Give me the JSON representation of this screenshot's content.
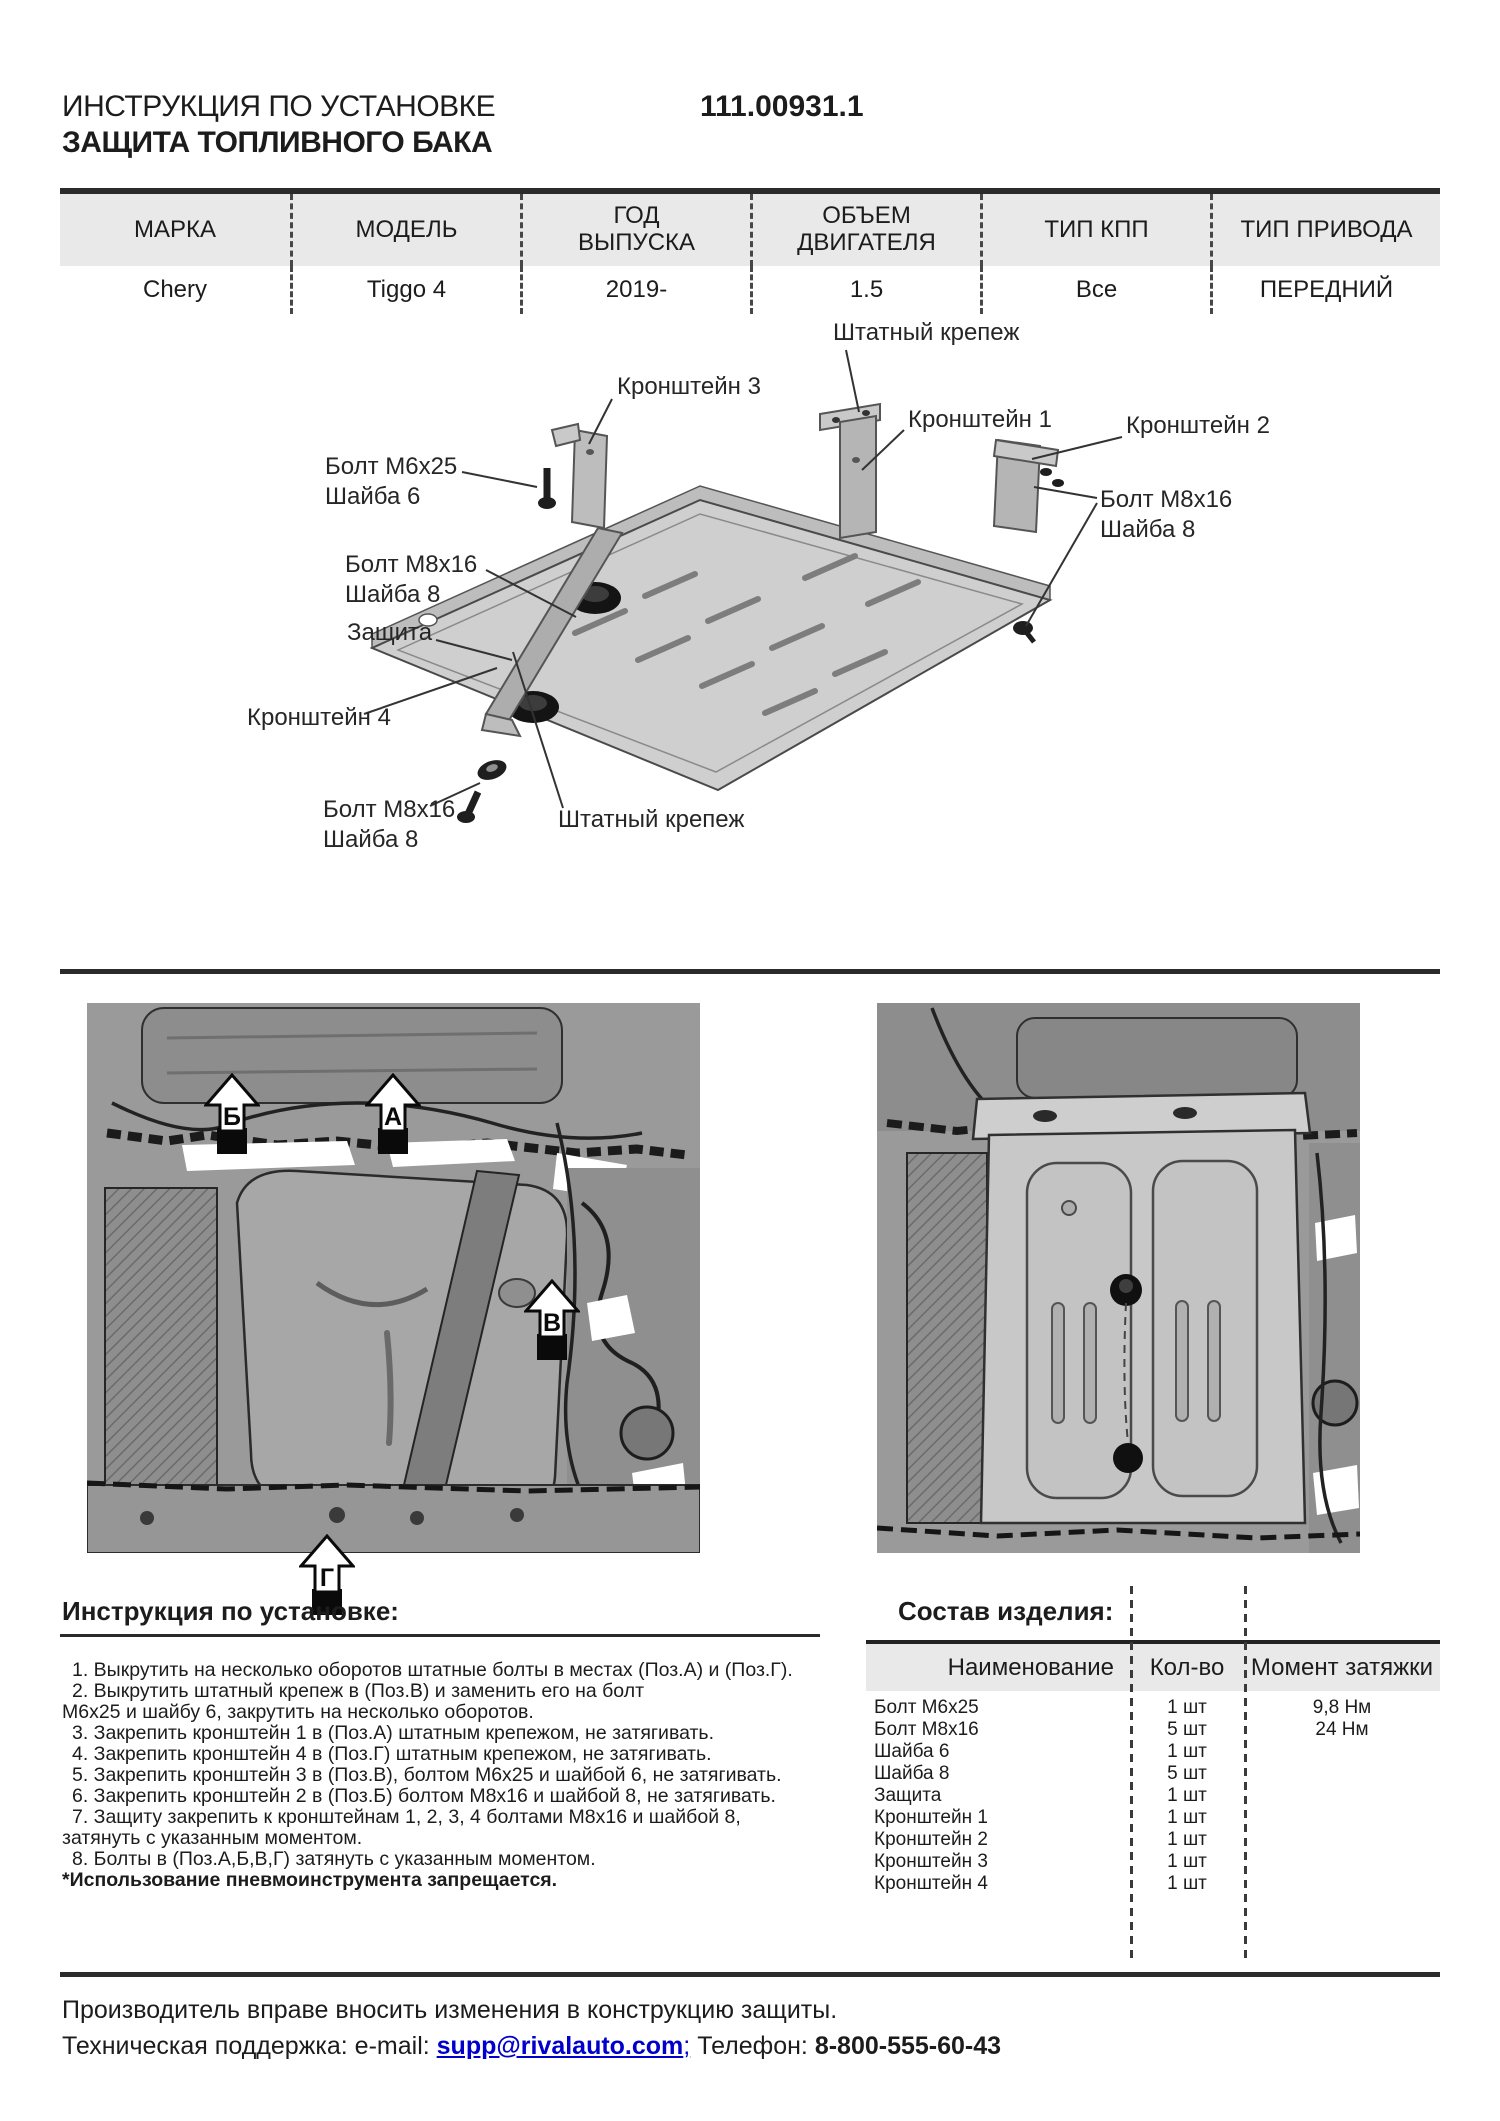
{
  "header": {
    "title_line1": "ИНСТРУКЦИЯ ПО УСТАНОВКЕ",
    "title_line2": "ЗАЩИТА ТОПЛИВНОГО БАКА",
    "part_number": "111.00931.1"
  },
  "vehicle_table": {
    "columns": [
      "МАРКА",
      "МОДЕЛЬ",
      "ГОД ВЫПУСКА",
      "ОБЪЕМ ДВИГАТЕЛЯ",
      "ТИП КПП",
      "ТИП ПРИВОДА"
    ],
    "values": [
      "Chery",
      "Tiggo 4",
      "2019-",
      "1.5",
      "Все",
      "ПЕРЕДНИЙ"
    ]
  },
  "diagram": {
    "labels": {
      "fastener_top": "Штатный крепеж",
      "bracket3": "Кронштейн 3",
      "bracket1": "Кронштейн 1",
      "bracket2": "Кронштейн 2",
      "bolt_m6": [
        "Болт М6х25",
        "Шайба 6"
      ],
      "bolt_m8_left": [
        "Болт М8х16",
        "Шайба 8"
      ],
      "bolt_m8_right": [
        "Болт М8х16",
        "Шайба 8"
      ],
      "shield": "Защита",
      "bracket4": "Кронштейн 4",
      "bolt_m8_bottom": [
        "Болт М8х16",
        "Шайба 8"
      ],
      "fastener_bottom": "Штатный крепеж"
    }
  },
  "photos": {
    "left": {
      "markers": [
        "Б",
        "А",
        "В",
        "Г"
      ]
    }
  },
  "instructions": {
    "heading": "Инструкция по установке:",
    "lines": [
      "1. Выкрутить на несколько оборотов штатные болты в местах (Поз.А) и (Поз.Г).",
      "2. Выкрутить штатный крепеж в (Поз.В) и заменить его на болт",
      "М6х25 и шайбу 6, закрутить на несколько оборотов.",
      "3. Закрепить кронштейн 1 в (Поз.А) штатным крепежом, не затягивать.",
      "4. Закрепить кронштейн 4 в (Поз.Г) штатным крепежом, не затягивать.",
      "5. Закрепить кронштейн 3 в (Поз.В), болтом М6х25 и шайбой 6, не затягивать.",
      "6. Закрепить кронштейн 2 в (Поз.Б) болтом М8х16 и шайбой 8, не затягивать.",
      "7. Защиту закрепить к кронштейнам 1, 2, 3, 4 болтами М8х16 и шайбой 8,",
      "затянуть с указанным моментом.",
      "8. Болты в (Поз.А,Б,В,Г) затянуть с указанным моментом."
    ],
    "warning": "*Использование пневмоинструмента запрещается."
  },
  "parts": {
    "heading": "Состав изделия:",
    "columns": [
      "Наименование",
      "Кол-во",
      "Момент затяжки"
    ],
    "rows": [
      {
        "name": "Болт М6х25",
        "qty": "1 шт",
        "torque": "9,8 Нм"
      },
      {
        "name": "Болт М8х16",
        "qty": "5 шт",
        "torque": "24 Нм"
      },
      {
        "name": "Шайба 6",
        "qty": "1 шт",
        "torque": ""
      },
      {
        "name": "Шайба 8",
        "qty": "5 шт",
        "torque": ""
      },
      {
        "name": "Защита",
        "qty": "1 шт",
        "torque": ""
      },
      {
        "name": "Кронштейн 1",
        "qty": "1 шт",
        "torque": ""
      },
      {
        "name": "Кронштейн 2",
        "qty": "1 шт",
        "torque": ""
      },
      {
        "name": "Кронштейн 3",
        "qty": "1 шт",
        "torque": ""
      },
      {
        "name": "Кронштейн 4",
        "qty": "1 шт",
        "torque": ""
      }
    ]
  },
  "footer": {
    "line1": "Производитель вправе вносить изменения в конструкцию защиты.",
    "support_label": "Техническая поддержка:  e-mail: ",
    "email": "supp@rivalauto.com",
    "email_suffix": ";",
    "phone_label": " Телефон: ",
    "phone": "8-800-555-60-43"
  }
}
